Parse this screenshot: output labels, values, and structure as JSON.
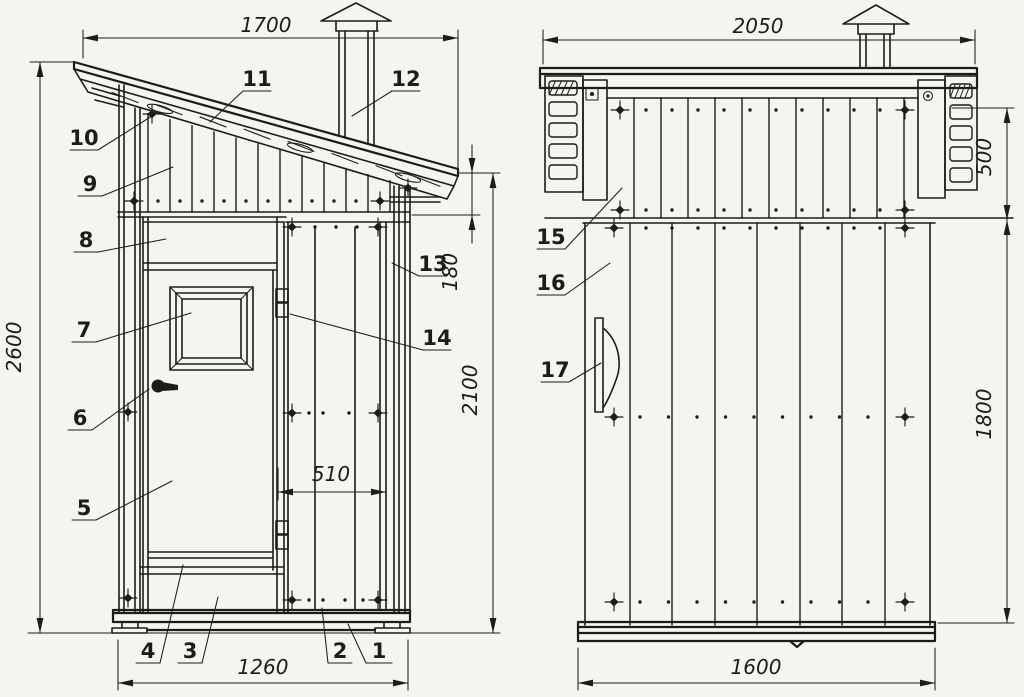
{
  "colors": {
    "paper": "#f5f4ee",
    "ink": "#1c1c1c"
  },
  "parts": [
    "1",
    "2",
    "3",
    "4",
    "5",
    "6",
    "7",
    "8",
    "9",
    "10",
    "11",
    "12",
    "13",
    "14",
    "15",
    "16",
    "17"
  ],
  "front_view": {
    "dims": {
      "roof_width": "1700",
      "total_height": "2600",
      "low_side_height": "2100",
      "eave_drop": "180",
      "bay_width": "510",
      "base_width": "1260"
    }
  },
  "side_view": {
    "dims": {
      "roof_depth": "2050",
      "gable_band_height": "500",
      "wall_height": "1800",
      "base_depth": "1600"
    }
  }
}
